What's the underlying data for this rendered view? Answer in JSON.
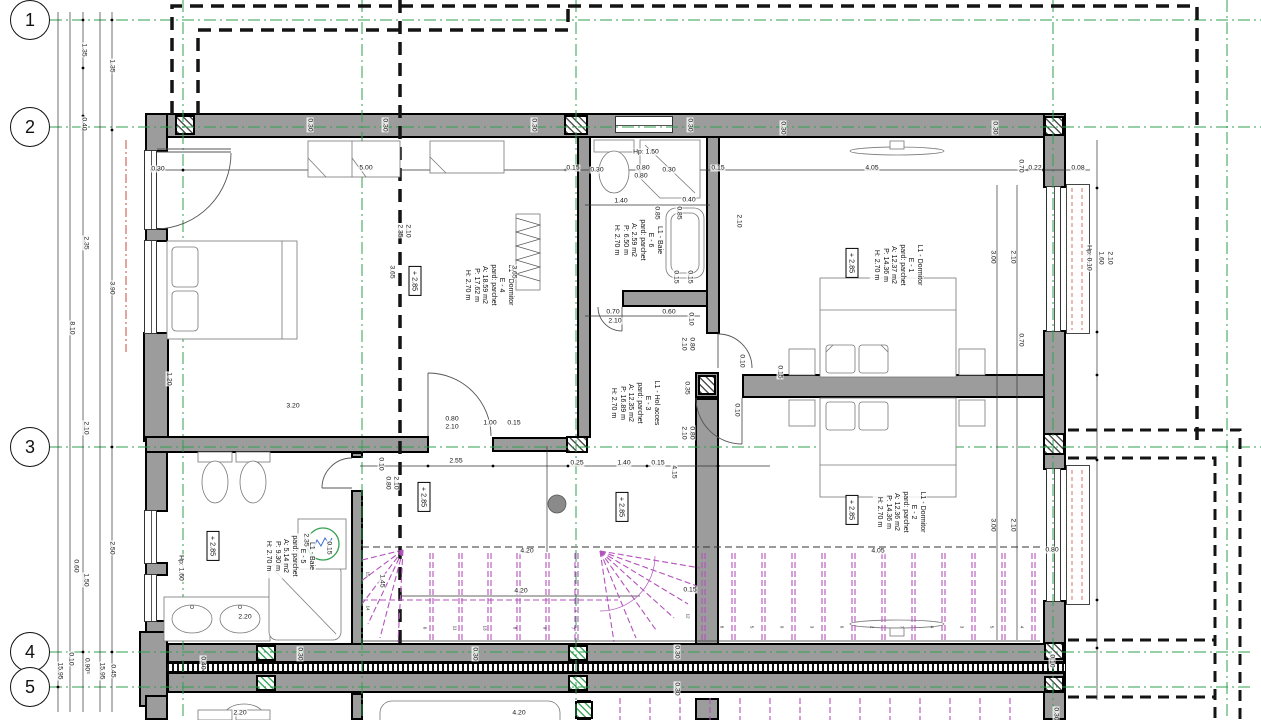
{
  "colors": {
    "wall": "#9c9c9c",
    "grid_green": "#2fa04e",
    "stairs_magenta": "#b352bd",
    "accent_red": "#c0392b",
    "ink": "#111111"
  },
  "grid_bubbles": [
    {
      "label": "1",
      "x": 30,
      "y": 20
    },
    {
      "label": "2",
      "x": 30,
      "y": 127
    },
    {
      "label": "3",
      "x": 30,
      "y": 447
    },
    {
      "label": "4",
      "x": 30,
      "y": 652
    },
    {
      "label": "5",
      "x": 30,
      "y": 687
    }
  ],
  "room_labels": [
    {
      "id": "e4",
      "x": 488,
      "y": 285,
      "lines": [
        "L1 - Dormitor",
        "E - 4",
        "pard: parchet",
        "A: 18.59 m2",
        "P: 17.62 m",
        "H: 2.70 m"
      ]
    },
    {
      "id": "e6",
      "x": 637,
      "y": 240,
      "lines": [
        "L1 - Baie",
        "E - 6",
        "pard: parchet",
        "A: 2.59 m2",
        "P: 6.50 m",
        "H: 2.70 m"
      ]
    },
    {
      "id": "e3",
      "x": 634,
      "y": 403,
      "lines": [
        "L1 - Hol acces",
        "E - 3",
        "pard: parchet",
        "A: 12.35 m2",
        "P: 16.89 m",
        "H: 2.70 m"
      ]
    },
    {
      "id": "e1",
      "x": 897,
      "y": 265,
      "lines": [
        "L1 - Dormitor",
        "E - 1",
        "pard: parchet",
        "A: 12.37 m2",
        "P: 14.36 m",
        "H: 2.70 m"
      ]
    },
    {
      "id": "e2",
      "x": 900,
      "y": 512,
      "lines": [
        "L1 - Dormitor",
        "E - 2",
        "pard: parchet",
        "A: 12.36 m2",
        "P: 14.36 m",
        "H: 2.70 m"
      ]
    },
    {
      "id": "e5",
      "x": 289,
      "y": 556,
      "lines": [
        "L1 - Baie",
        "E - 5",
        "pard: parchet",
        "A: 5.14 m2",
        "P: 9.30 m",
        "H: 2.70 m"
      ]
    }
  ],
  "level_markers": [
    {
      "text": "+ 2.85",
      "x": 415,
      "y": 281
    },
    {
      "text": "+ 2.85",
      "x": 424,
      "y": 497
    },
    {
      "text": "+ 2.85",
      "x": 622,
      "y": 507
    },
    {
      "text": "+ 2.85",
      "x": 852,
      "y": 263
    },
    {
      "text": "+ 2.85",
      "x": 852,
      "y": 510
    },
    {
      "text": "+ 2.85",
      "x": 213,
      "y": 546
    }
  ],
  "dims": [
    [
      "1.35",
      84,
      50,
      1
    ],
    [
      "1.35",
      112,
      66,
      1
    ],
    [
      "0.40",
      84,
      124,
      1
    ],
    [
      "2.35",
      86,
      243,
      1
    ],
    [
      "3.90",
      112,
      288,
      1
    ],
    [
      "8.10",
      72,
      328,
      1
    ],
    [
      "2.10",
      86,
      428,
      1
    ],
    [
      "2.50",
      112,
      548,
      1
    ],
    [
      "0.60",
      76,
      566,
      1
    ],
    [
      "1.50",
      86,
      580,
      1
    ],
    [
      "0.10",
      71,
      659,
      1
    ],
    [
      "0.90⁵",
      87,
      666,
      1
    ],
    [
      "15.95",
      60,
      671,
      1
    ],
    [
      "15.95",
      102,
      671,
      1
    ],
    [
      "0.45",
      113,
      671,
      1
    ],
    [
      "0.30",
      158,
      169,
      0
    ],
    [
      "5.00",
      366,
      168,
      0
    ],
    [
      "0.15",
      573,
      168,
      0
    ],
    [
      "0.22",
      1035,
      168,
      0
    ],
    [
      "0.08",
      1078,
      168,
      0
    ],
    [
      "0.70",
      1021,
      166,
      1
    ],
    [
      "0.30",
      310,
      125,
      1
    ],
    [
      "0.30",
      385,
      125,
      1
    ],
    [
      "0.30",
      534,
      125,
      1
    ],
    [
      "0.30",
      690,
      125,
      1
    ],
    [
      "0.30",
      783,
      128,
      1
    ],
    [
      "0.30",
      995,
      128,
      1
    ],
    [
      "Hp: 1.50",
      646,
      152,
      0
    ],
    [
      "0.30",
      597,
      170,
      0
    ],
    [
      "0.80",
      643,
      168,
      0
    ],
    [
      "0.80",
      641,
      176,
      0
    ],
    [
      "0.30",
      669,
      170,
      0
    ],
    [
      "0.15",
      718,
      168,
      0
    ],
    [
      "1.40",
      621,
      201,
      0
    ],
    [
      "0.40",
      689,
      200,
      0
    ],
    [
      "0.85",
      657,
      213,
      1
    ],
    [
      "0.85",
      679,
      213,
      1
    ],
    [
      "2.10",
      739,
      221,
      1
    ],
    [
      "0.15",
      676,
      277,
      1
    ],
    [
      "0.15",
      690,
      277,
      1
    ],
    [
      "0.70",
      613,
      312,
      0
    ],
    [
      "2.10",
      615,
      321,
      0
    ],
    [
      "0.60",
      669,
      312,
      0
    ],
    [
      "0.10",
      691,
      319,
      1
    ],
    [
      "2.35",
      400,
      231,
      1
    ],
    [
      "2.10",
      408,
      231,
      1
    ],
    [
      "3.65",
      392,
      272,
      1
    ],
    [
      "3.65",
      514,
      272,
      1
    ],
    [
      "1.20",
      169,
      379,
      1
    ],
    [
      "3.20",
      293,
      406,
      0
    ],
    [
      "0.80",
      452,
      419,
      0
    ],
    [
      "2.10",
      452,
      427,
      0
    ],
    [
      "1.00",
      490,
      423,
      0
    ],
    [
      "0.15",
      514,
      423,
      0
    ],
    [
      "0.10",
      381,
      464,
      1
    ],
    [
      "0.80",
      388,
      483,
      1
    ],
    [
      "2.10",
      396,
      483,
      1
    ],
    [
      "2.55",
      456,
      461,
      0
    ],
    [
      "0.25",
      577,
      463,
      0
    ],
    [
      "1.40",
      624,
      463,
      0
    ],
    [
      "0.15",
      658,
      463,
      0
    ],
    [
      "4.15",
      674,
      472,
      1
    ],
    [
      "2.10",
      684,
      344,
      1
    ],
    [
      "0.80",
      692,
      344,
      1
    ],
    [
      "0.10",
      742,
      361,
      1
    ],
    [
      "0.35",
      687,
      388,
      1
    ],
    [
      "0.10",
      737,
      410,
      1
    ],
    [
      "2.10",
      684,
      433,
      1
    ],
    [
      "0.80",
      692,
      433,
      1
    ],
    [
      "0.15",
      780,
      372,
      1
    ],
    [
      "4.05",
      872,
      168,
      0
    ],
    [
      "3.00",
      993,
      257,
      1
    ],
    [
      "2.10",
      1013,
      257,
      1
    ],
    [
      "Hp: 0.10",
      1089,
      258,
      1
    ],
    [
      "1.60",
      1101,
      258,
      1
    ],
    [
      "2.10",
      1110,
      258,
      1
    ],
    [
      "0.70",
      1021,
      340,
      1
    ],
    [
      "4.05",
      878,
      551,
      0
    ],
    [
      "3.00",
      993,
      525,
      1
    ],
    [
      "2.10",
      1013,
      525,
      1
    ],
    [
      "0.80",
      1052,
      550,
      0
    ],
    [
      "2.35",
      306,
      540,
      1
    ],
    [
      "0.15",
      329,
      548,
      1
    ],
    [
      "Hp: 1.60",
      181,
      568,
      1
    ],
    [
      "2.20",
      245,
      617,
      0
    ],
    [
      "1.45",
      382,
      581,
      1
    ],
    [
      "4.20",
      527,
      551,
      0
    ],
    [
      "4.20",
      521,
      591,
      0
    ],
    [
      "0.15",
      690,
      590,
      0
    ],
    [
      "0.30",
      300,
      654,
      1
    ],
    [
      "0.30",
      475,
      654,
      1
    ],
    [
      "0.30",
      677,
      652,
      1
    ],
    [
      "0.30",
      677,
      689,
      1
    ],
    [
      "0.40",
      203,
      663,
      1
    ],
    [
      "0.10",
      1052,
      661,
      1
    ],
    [
      "0.30",
      1056,
      714,
      1
    ],
    [
      "2.20",
      240,
      713,
      0
    ],
    [
      "4.20",
      519,
      713,
      0
    ]
  ],
  "stair_numbers": [
    {
      "n": "15",
      "x": 368,
      "y": 574
    },
    {
      "n": "14",
      "x": 368,
      "y": 608
    },
    {
      "n": "6",
      "x": 425,
      "y": 628
    },
    {
      "n": "11",
      "x": 455,
      "y": 628
    },
    {
      "n": "13",
      "x": 485,
      "y": 628
    },
    {
      "n": "8",
      "x": 515,
      "y": 628
    },
    {
      "n": "9",
      "x": 545,
      "y": 628
    },
    {
      "n": "7",
      "x": 573,
      "y": 628
    },
    {
      "n": "12",
      "x": 688,
      "y": 616
    },
    {
      "n": "8",
      "x": 722,
      "y": 627
    },
    {
      "n": "5",
      "x": 752,
      "y": 627
    },
    {
      "n": "9",
      "x": 782,
      "y": 627
    },
    {
      "n": "3",
      "x": 812,
      "y": 627
    },
    {
      "n": "6",
      "x": 842,
      "y": 627
    },
    {
      "n": "2",
      "x": 872,
      "y": 627
    },
    {
      "n": "7",
      "x": 902,
      "y": 627
    },
    {
      "n": "4",
      "x": 932,
      "y": 627
    },
    {
      "n": "3",
      "x": 962,
      "y": 627
    },
    {
      "n": "5",
      "x": 992,
      "y": 627
    },
    {
      "n": "4",
      "x": 1022,
      "y": 627
    }
  ]
}
